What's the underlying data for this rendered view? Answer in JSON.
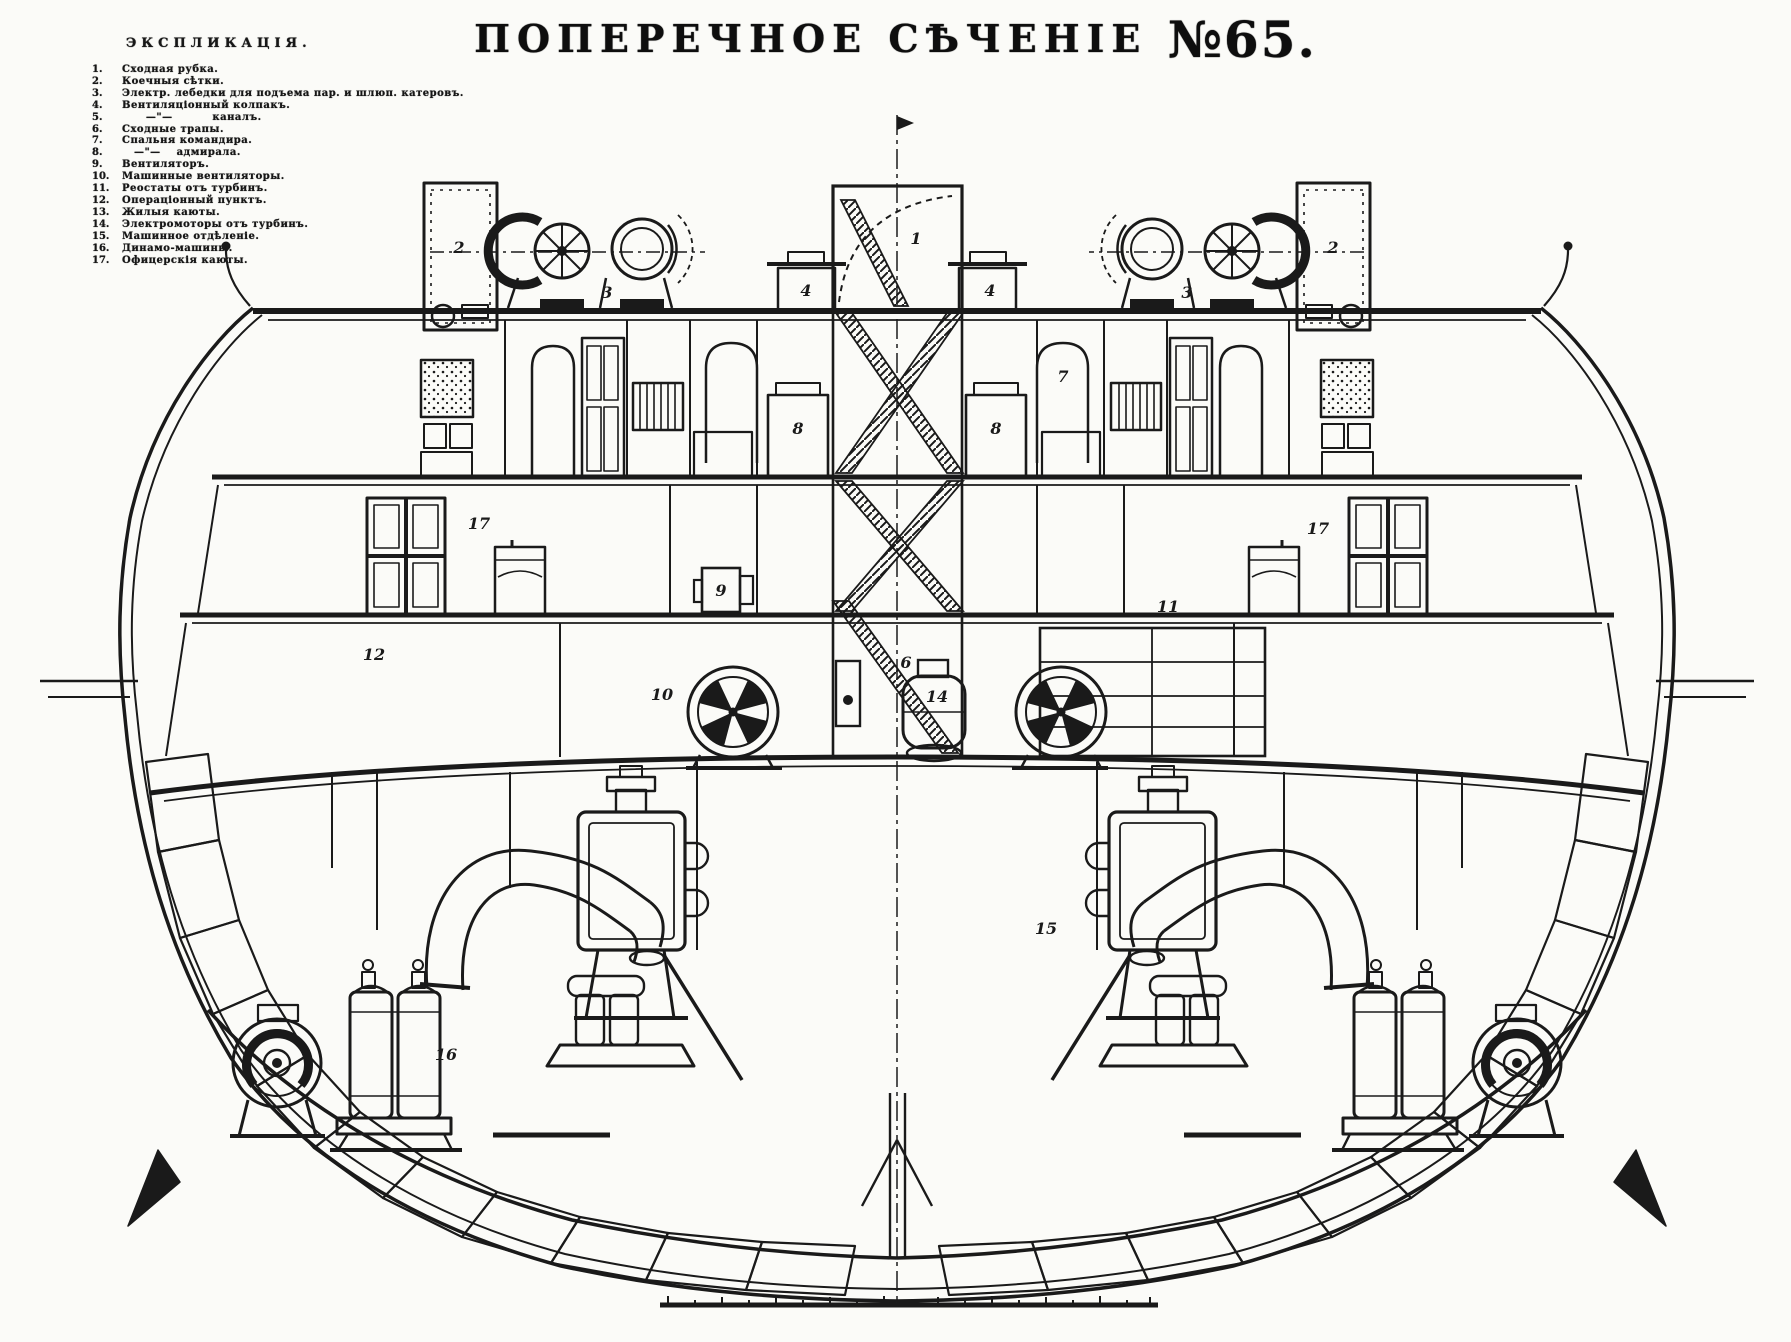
{
  "title": {
    "main": "ПОПЕРЕЧНОЕ СѢЧЕНІЕ ",
    "number": "№65."
  },
  "legend": {
    "header": "ЭКСПЛИКАЦІЯ.",
    "items": [
      {
        "num": "1.",
        "text": "Сходная рубка."
      },
      {
        "num": "2.",
        "text": "Коечныя сѣтки."
      },
      {
        "num": "3.",
        "text": "Электр. лебедки для подъема пар. и шлюп. катеровъ."
      },
      {
        "num": "4.",
        "text": "Вентиляціонный колпакъ."
      },
      {
        "num": "5.",
        "text": "      —\"—          каналъ."
      },
      {
        "num": "6.",
        "text": "Сходные трапы."
      },
      {
        "num": "7.",
        "text": "Спальня командира."
      },
      {
        "num": "8.",
        "text": "   —\"—    адмирала."
      },
      {
        "num": "9.",
        "text": "Вентиляторъ."
      },
      {
        "num": "10.",
        "text": "Машинные вентиляторы."
      },
      {
        "num": "11.",
        "text": "Реостаты отъ турбинъ."
      },
      {
        "num": "12.",
        "text": "Операціонный пунктъ."
      },
      {
        "num": "13.",
        "text": "Жилыя каюты."
      },
      {
        "num": "14.",
        "text": "Электромоторы отъ турбинъ."
      },
      {
        "num": "15.",
        "text": "Машинное отдѣленіе."
      },
      {
        "num": "16.",
        "text": "Динамо-машины."
      },
      {
        "num": "17.",
        "text": "Офицерскія каюты."
      }
    ]
  },
  "drawing": {
    "ink": "#1a1a1a",
    "paper": "#fbfbf8",
    "callouts": [
      {
        "label": "1",
        "x": 916,
        "y": 244
      },
      {
        "label": "2",
        "x": 459,
        "y": 253
      },
      {
        "label": "2",
        "x": 1333,
        "y": 253
      },
      {
        "label": "3",
        "x": 607,
        "y": 298
      },
      {
        "label": "3",
        "x": 1187,
        "y": 298
      },
      {
        "label": "4",
        "x": 806,
        "y": 296
      },
      {
        "label": "4",
        "x": 990,
        "y": 296
      },
      {
        "label": "7",
        "x": 1063,
        "y": 382
      },
      {
        "label": "8",
        "x": 798,
        "y": 434
      },
      {
        "label": "8",
        "x": 996,
        "y": 434
      },
      {
        "label": "17",
        "x": 479,
        "y": 529
      },
      {
        "label": "17",
        "x": 1318,
        "y": 534
      },
      {
        "label": "9",
        "x": 721,
        "y": 596
      },
      {
        "label": "12",
        "x": 374,
        "y": 660
      },
      {
        "label": "11",
        "x": 1168,
        "y": 612
      },
      {
        "label": "6",
        "x": 906,
        "y": 668
      },
      {
        "label": "14",
        "x": 937,
        "y": 702
      },
      {
        "label": "10",
        "x": 662,
        "y": 700
      },
      {
        "label": "15",
        "x": 1046,
        "y": 934
      },
      {
        "label": "16",
        "x": 446,
        "y": 1060
      }
    ]
  }
}
